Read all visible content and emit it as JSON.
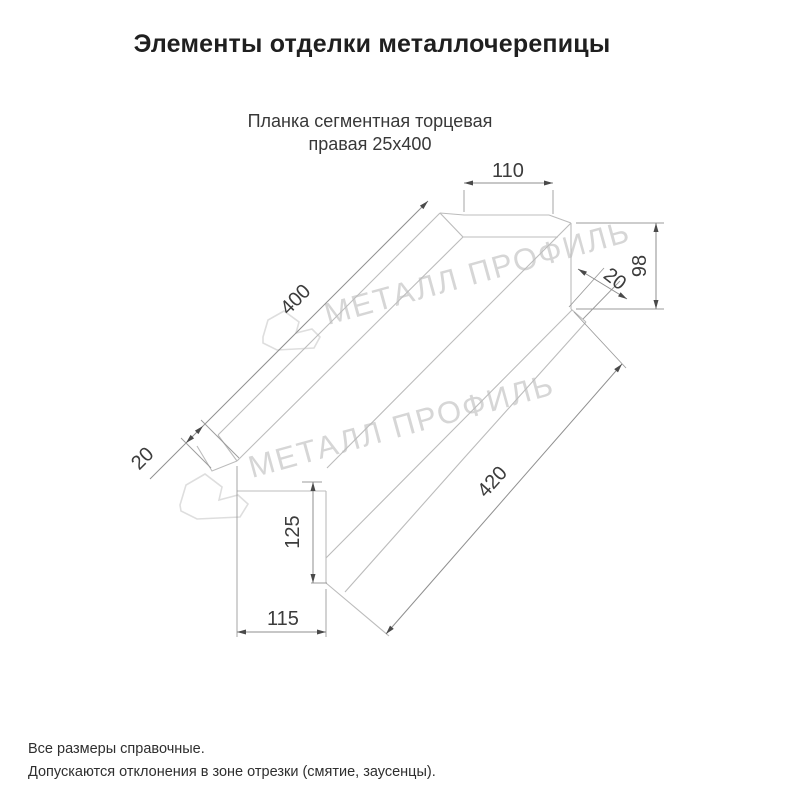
{
  "header": {
    "title": "Элементы отделки металлочерепицы"
  },
  "product": {
    "name_line1": "Планка сегментная торцевая",
    "name_line2": "правая 25х400"
  },
  "drawing": {
    "type": "technical-dimension-drawing",
    "dims": {
      "top_face_width": "110",
      "end_height": "98",
      "end_hem_width": "20",
      "length_top": "400",
      "left_flange_width": "20",
      "front_height": "125",
      "bottom_width": "115",
      "length_bottom": "420"
    },
    "watermark": {
      "text": "МЕТАЛЛ ПРОФИЛЬ"
    },
    "colors": {
      "piece_line": "#bcbcbc",
      "dimension_line": "#8f8f8f",
      "dimension_text": "#3c3c3c",
      "watermark": "#d6d6d6",
      "background": "#ffffff"
    }
  },
  "footer": {
    "note_line1": "Все размеры справочные.",
    "note_line2": "Допускаются отклонения в зоне отрезки (смятие, заусенцы)."
  }
}
